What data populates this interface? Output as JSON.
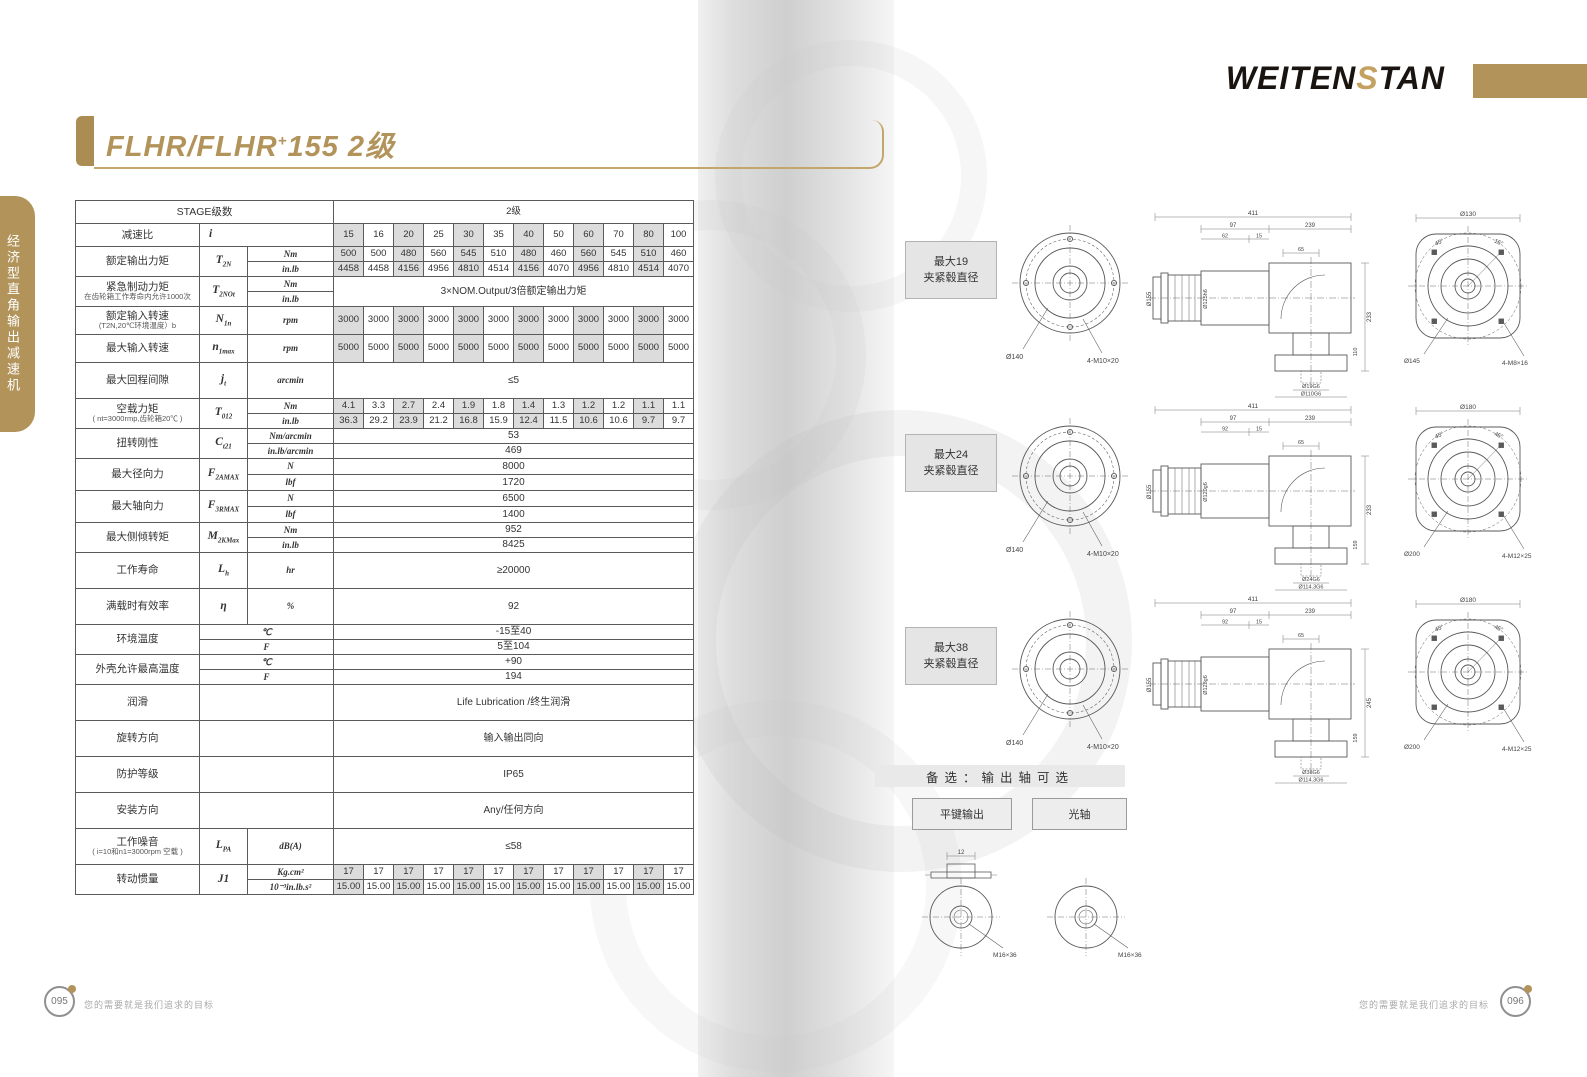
{
  "brand": {
    "pre": "WEITEN",
    "mid": "S",
    "post": "TAN"
  },
  "title": {
    "main": "FLHR/FLHR",
    "sup": "+",
    "rest": "155 2级"
  },
  "side_tab": "经济型直角输出减速机",
  "accent_gold": "#b2945b",
  "table": {
    "header": {
      "stage_label": "STAGE级数",
      "stage_value": "2级",
      "ratio_label": "减速比",
      "ratio_symbol": "i",
      "ratios": [
        "15",
        "16",
        "20",
        "25",
        "30",
        "35",
        "40",
        "50",
        "60",
        "70",
        "80",
        "100"
      ]
    },
    "groups": [
      {
        "label": "额定输出力矩",
        "sym": "T",
        "sub": "2N",
        "h": 15,
        "rows": [
          {
            "unit": "Nm",
            "cells": [
              "500",
              "500",
              "480",
              "560",
              "545",
              "510",
              "480",
              "460",
              "560",
              "545",
              "510",
              "460"
            ]
          },
          {
            "unit": "in.lb",
            "cells": [
              "4458",
              "4458",
              "4156",
              "4956",
              "4810",
              "4514",
              "4156",
              "4070",
              "4956",
              "4810",
              "4514",
              "4070"
            ]
          }
        ]
      },
      {
        "label": "紧急制动力矩",
        "label2": "在齿轮箱工作寿命内允许1000次",
        "sym": "T",
        "sub": "2NOt",
        "h": 15,
        "span": "3×NOM.Output/3倍额定输出力矩",
        "rows": [
          {
            "unit": "Nm"
          },
          {
            "unit": "in.lb"
          }
        ]
      },
      {
        "label": "额定输入转速",
        "label2": "(T2N,20℃环境温度）b",
        "sym": "N",
        "sub": "1n",
        "h": 28,
        "rows": [
          {
            "unit": "rpm",
            "cells": [
              "3000",
              "3000",
              "3000",
              "3000",
              "3000",
              "3000",
              "3000",
              "3000",
              "3000",
              "3000",
              "3000",
              "3000"
            ]
          }
        ]
      },
      {
        "label": "最大输入转速",
        "sym": "n",
        "sub": "1max",
        "h": 28,
        "rows": [
          {
            "unit": "rpm",
            "cells": [
              "5000",
              "5000",
              "5000",
              "5000",
              "5000",
              "5000",
              "5000",
              "5000",
              "5000",
              "5000",
              "5000",
              "5000"
            ]
          }
        ]
      },
      {
        "label": "最大回程间隙",
        "sym": "j",
        "sub": "t",
        "h": 36,
        "rows": [
          {
            "unit": "arcmin",
            "span": "≤5"
          }
        ]
      },
      {
        "label": "空载力矩",
        "label2": "( nt=3000rmp,齿轮箱20℃ )",
        "sym": "T",
        "sub": "012",
        "h": 15,
        "rows": [
          {
            "unit": "Nm",
            "cells": [
              "4.1",
              "3.3",
              "2.7",
              "2.4",
              "1.9",
              "1.8",
              "1.4",
              "1.3",
              "1.2",
              "1.2",
              "1.1",
              "1.1"
            ]
          },
          {
            "unit": "in.lb",
            "cells": [
              "36.3",
              "29.2",
              "23.9",
              "21.2",
              "16.8",
              "15.9",
              "12.4",
              "11.5",
              "10.6",
              "10.6",
              "9.7",
              "9.7"
            ]
          }
        ]
      },
      {
        "label": "扭转刚性",
        "sym": "C",
        "sub": "t21",
        "h": 15,
        "rows": [
          {
            "unit": "Nm/arcmin",
            "span": "53"
          },
          {
            "unit": "in.lb/arcmin",
            "span": "469"
          }
        ]
      },
      {
        "label": "最大径向力",
        "sym": "F",
        "sub": "2AMAX",
        "h": 16,
        "rows": [
          {
            "unit": "N",
            "span": "8000"
          },
          {
            "unit": "lbf",
            "span": "1720"
          }
        ]
      },
      {
        "label": "最大轴向力",
        "sym": "F",
        "sub": "3RMAX",
        "h": 16,
        "rows": [
          {
            "unit": "N",
            "span": "6500"
          },
          {
            "unit": "lbf",
            "span": "1400"
          }
        ]
      },
      {
        "label": "最大侧倾转矩",
        "sym": "M",
        "sub": "2KMax",
        "h": 15,
        "rows": [
          {
            "unit": "Nm",
            "span": "952"
          },
          {
            "unit": "in.lb",
            "span": "8425"
          }
        ]
      },
      {
        "label": "工作寿命",
        "sym": "L",
        "sub": "h",
        "h": 36,
        "rows": [
          {
            "unit": "hr",
            "span": "≥20000"
          }
        ]
      },
      {
        "label": "满载时有效率",
        "sym": "η",
        "h": 36,
        "rows": [
          {
            "unit": "%",
            "span": "92"
          }
        ]
      },
      {
        "label": "环境温度",
        "merge_unit": true,
        "h": 15,
        "rows": [
          {
            "unit": "℃",
            "span": "-15至40"
          },
          {
            "unit": "F",
            "span": "5至104"
          }
        ]
      },
      {
        "label": "外壳允许最高温度",
        "merge_unit": true,
        "h": 15,
        "rows": [
          {
            "unit": "℃",
            "span": "+90"
          },
          {
            "unit": "F",
            "span": "194"
          }
        ]
      },
      {
        "label": "润滑",
        "merge_unit": true,
        "h": 36,
        "rows": [
          {
            "unit": "",
            "span": "Life Lubrication /终生润滑"
          }
        ]
      },
      {
        "label": "旋转方向",
        "merge_unit": true,
        "h": 36,
        "rows": [
          {
            "unit": "",
            "span": "输入输出同向"
          }
        ]
      },
      {
        "label": "防护等级",
        "merge_unit": true,
        "h": 36,
        "rows": [
          {
            "unit": "",
            "span": "IP65"
          }
        ]
      },
      {
        "label": "安装方向",
        "merge_unit": true,
        "h": 36,
        "rows": [
          {
            "unit": "",
            "span": "Any/任何方向"
          }
        ]
      },
      {
        "label": "工作噪音",
        "label2": "( i=10和n1=3000rpm 空载 )",
        "sym": "L",
        "sub": "PA",
        "h": 36,
        "rows": [
          {
            "unit": "dB(A)",
            "span": "≤58"
          }
        ]
      },
      {
        "label": "转动惯量",
        "sym": "J1",
        "h": 15,
        "rows": [
          {
            "unit": "Kg.cm²",
            "cells": [
              "17",
              "17",
              "17",
              "17",
              "17",
              "17",
              "17",
              "17",
              "17",
              "17",
              "17",
              "17"
            ]
          },
          {
            "unit": "10⁻³in.lb.s²",
            "cells": [
              "15.00",
              "15.00",
              "15.00",
              "15.00",
              "15.00",
              "15.00",
              "15.00",
              "15.00",
              "15.00",
              "15.00",
              "15.00",
              "15.00"
            ]
          }
        ]
      }
    ]
  },
  "drawings": [
    {
      "label_line1": "最大19",
      "label_line2": "夹紧毂直径",
      "front": {
        "callouts": [
          "Ø140",
          "4-M10×20"
        ]
      },
      "side": {
        "dims_top": [
          "411",
          "97",
          "239",
          "62",
          "15",
          "65"
        ],
        "dims_left": [
          "Ø155",
          "Ø125h6"
        ],
        "dims_right": [
          "233",
          "110"
        ],
        "dims_bottom": [
          "Ø19G6",
          "Ø110G6"
        ]
      },
      "flange": {
        "dim_top": "Ø130",
        "angles": [
          "45°",
          "15°"
        ],
        "callouts": [
          "Ø145",
          "4-M8×16"
        ]
      }
    },
    {
      "label_line1": "最大24",
      "label_line2": "夹紧毂直径",
      "front": {
        "callouts": [
          "Ø140",
          "4-M10×20"
        ]
      },
      "side": {
        "dims_top": [
          "411",
          "97",
          "239",
          "92",
          "15",
          "65"
        ],
        "dims_left": [
          "Ø155",
          "Ø120g6"
        ],
        "dims_right": [
          "233",
          "159"
        ],
        "dims_bottom": [
          "Ø24G6",
          "Ø114.3G6"
        ]
      },
      "flange": {
        "dim_top": "Ø180",
        "angles": [
          "45°",
          "45°"
        ],
        "callouts": [
          "Ø200",
          "4-M12×25"
        ]
      }
    },
    {
      "label_line1": "最大38",
      "label_line2": "夹紧毂直径",
      "front": {
        "callouts": [
          "Ø140",
          "4-M10×20"
        ]
      },
      "side": {
        "dims_top": [
          "411",
          "97",
          "239",
          "92",
          "15",
          "65"
        ],
        "dims_left": [
          "Ø155",
          "Ø128g6"
        ],
        "dims_right": [
          "245",
          "159"
        ],
        "dims_bottom": [
          "Ø38G6",
          "Ø114.3G6"
        ]
      },
      "flange": {
        "dim_top": "Ø180",
        "angles": [
          "45°",
          "45°"
        ],
        "callouts": [
          "Ø200",
          "4-M12×25"
        ]
      }
    }
  ],
  "options": {
    "header": "备选：输出轴可选",
    "items": [
      "平键输出",
      "光轴"
    ],
    "shafts": [
      {
        "name": "平键输出",
        "callout": "M16×36",
        "key_dim": "12"
      },
      {
        "name": "光轴",
        "callout": "M16×36"
      }
    ]
  },
  "footer": {
    "slogan": "您的需要就是我们追求的目标",
    "page_left": "095",
    "page_right": "096"
  }
}
